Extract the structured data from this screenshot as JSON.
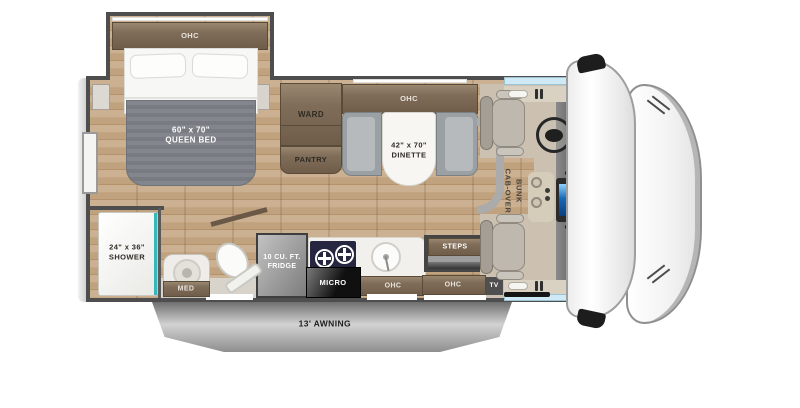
{
  "floorplan": {
    "bedroom": {
      "ohc_label": "OHC",
      "bed_size": "60\" x 70\"",
      "bed_type": "QUEEN BED",
      "ward_label": "WARD",
      "pantry_label": "PANTRY"
    },
    "dinette": {
      "ohc_label": "OHC",
      "size": "42\" x 70\"",
      "name": "DINETTE"
    },
    "bathroom": {
      "shower_size": "24\" x 36\"",
      "shower_name": "SHOWER",
      "med_label": "MED"
    },
    "galley": {
      "fridge_size": "10 CU. FT.",
      "fridge_name": "FRIDGE",
      "micro_label": "MICRO",
      "ohc_label": "OHC"
    },
    "entry": {
      "steps_label": "STEPS",
      "ohc_label": "OHC",
      "tv_label": "TV"
    },
    "cab": {
      "bunk_label_line1": "CAB-OVER",
      "bunk_label_line2": "BUNK"
    },
    "exterior": {
      "awning_label": "13' AWNING"
    }
  },
  "colors": {
    "wall": "#4e4e4e",
    "wood_floor": "#c4a782",
    "cabinet_brown": "#7c6a57",
    "accent_teal": "#35b8bb",
    "window_blue": "#cfeaf4",
    "bench_gray": "#9aa0a3",
    "seat_beige": "#beb8ae",
    "awning_gray": "#a9a9a9",
    "cooktop_navy": "#262640",
    "screen_blue": "#1668b8"
  }
}
